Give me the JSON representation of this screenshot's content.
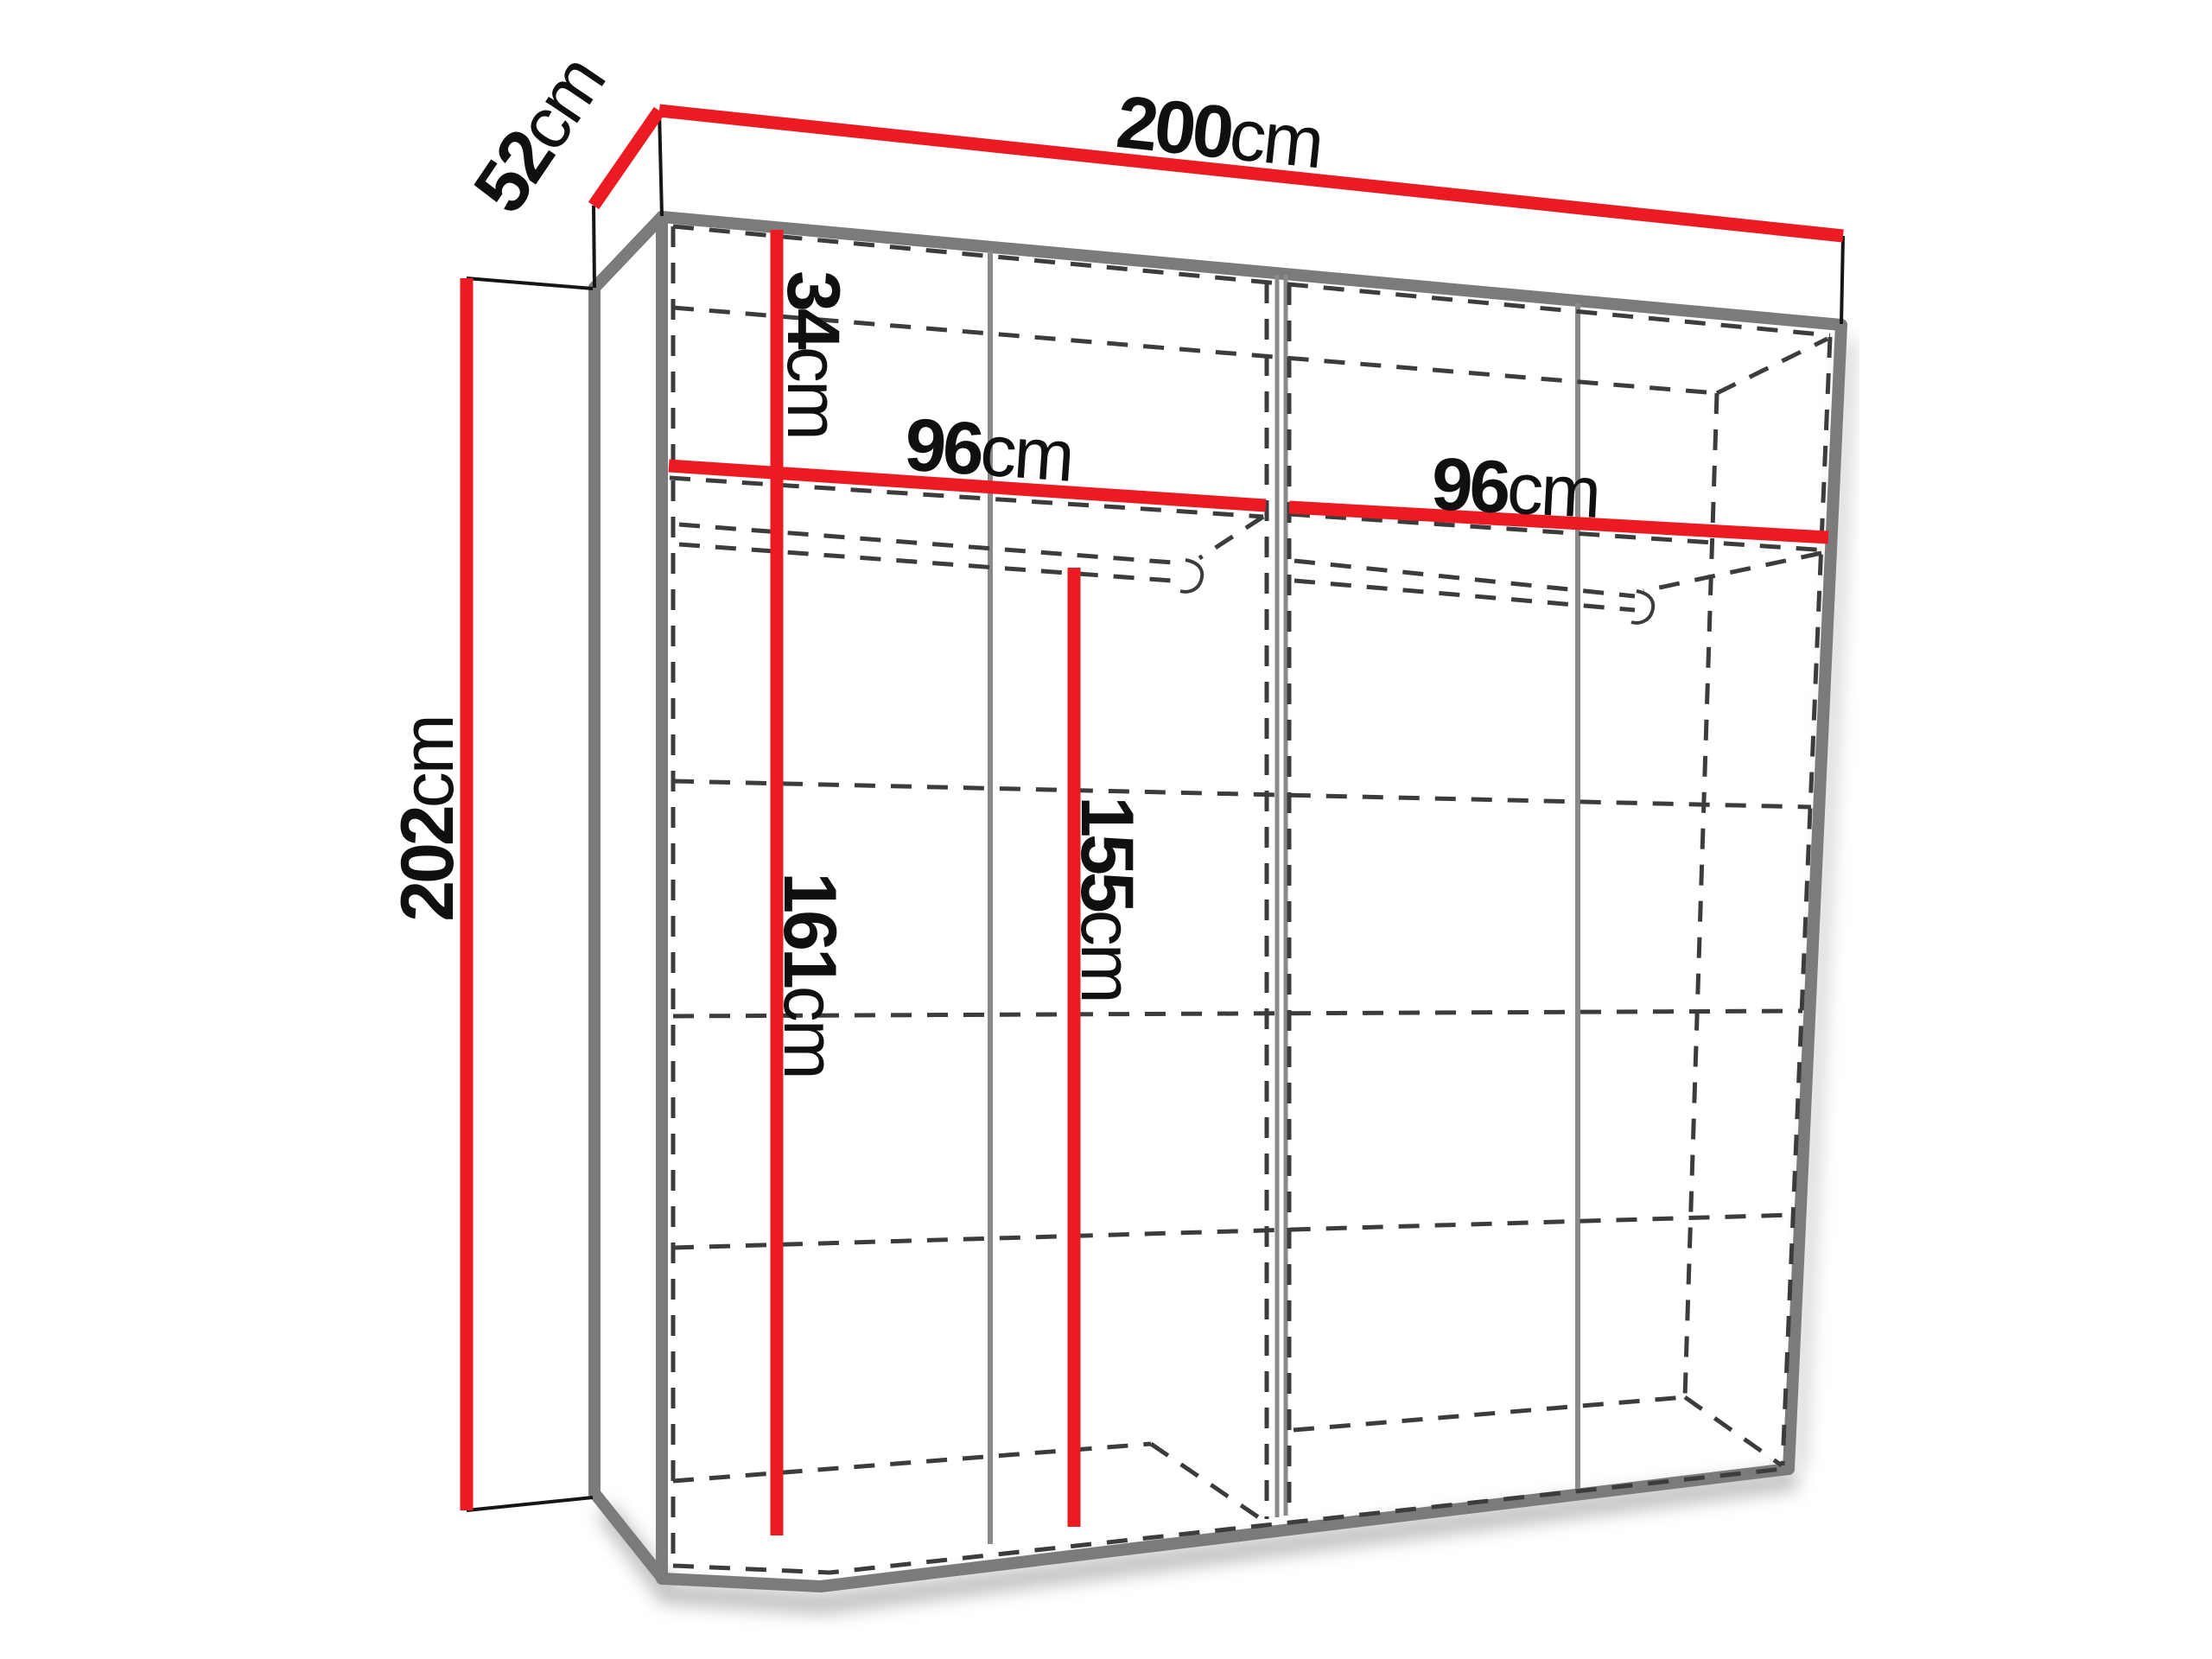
{
  "diagram": {
    "kind": "wardrobe-dimension-drawing",
    "colors": {
      "dimension_line": "#ec1b23",
      "structure_edge": "#7b7b7b",
      "panel_divider": "#8a8a8a",
      "hidden_line": "#3c3c3c",
      "tick_line": "#151515",
      "label_text": "#101010",
      "background": "#ffffff"
    },
    "labels": {
      "width_total": {
        "value": "200",
        "unit": "cm"
      },
      "depth": {
        "value": "52",
        "unit": "cm"
      },
      "height_total": {
        "value": "202",
        "unit": "cm"
      },
      "top_section_height": {
        "value": "34",
        "unit": "cm"
      },
      "left_section_width": {
        "value": "96",
        "unit": "cm"
      },
      "right_section_width": {
        "value": "96",
        "unit": "cm"
      },
      "left_section_height": {
        "value": "161",
        "unit": "cm"
      },
      "right_section_height": {
        "value": "155",
        "unit": "cm"
      }
    }
  }
}
